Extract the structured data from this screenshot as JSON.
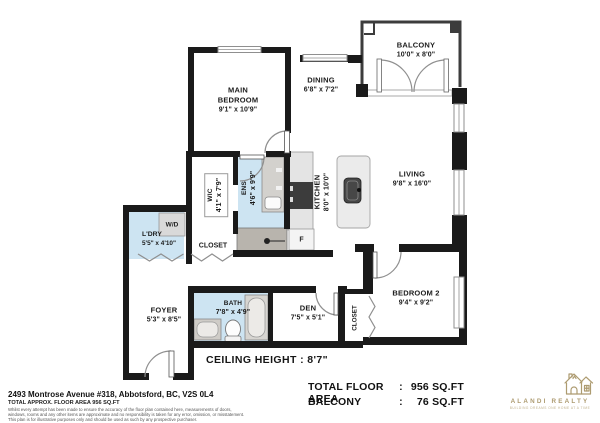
{
  "rooms": {
    "main_bedroom": {
      "name": "MAIN BEDROOM",
      "dims": "9'1\" x 10'9\""
    },
    "dining": {
      "name": "DINING",
      "dims": "6'8\" x 7'2\""
    },
    "balcony": {
      "name": "BALCONY",
      "dims": "10'0\" x 8'0\""
    },
    "living": {
      "name": "LIVING",
      "dims": "9'8\" x 16'0\""
    },
    "kitchen": {
      "name": "KITCHEN",
      "dims": "8'0\" x 10'0\""
    },
    "wic": {
      "name": "WIC",
      "dims": "4'1\" x 7'9\""
    },
    "ens": {
      "name": "ENS",
      "dims": "4'6\" x 9'9\""
    },
    "ldry": {
      "name": "L'DRY",
      "dims": "5'5\" x 4'10\""
    },
    "closet_hall": {
      "name": "CLOSET"
    },
    "foyer": {
      "name": "FOYER",
      "dims": "5'3\" x 8'5\""
    },
    "bath": {
      "name": "BATH",
      "dims": "7'8\" x 4'9\""
    },
    "den": {
      "name": "DEN",
      "dims": "7'5\" x 5'1\""
    },
    "bedroom2": {
      "name": "BEDROOM 2",
      "dims": "9'4\" x 9'2\""
    },
    "closet_bd2": {
      "name": "CLOSET"
    }
  },
  "appliances": {
    "washer_dryer": "W/D",
    "fridge": "F"
  },
  "ceiling_height": "CEILING HEIGHT : 8'7\"",
  "footer": {
    "address": "2493 Montrose Avenue #318, Abbotsford, BC, V2S 0L4",
    "approx_line": "TOTAL APPROX. FLOOR AREA 956 SQ.FT",
    "disclaimer_1": "Whilst every attempt has been made to ensure the accuracy of the floor plan contained here, measurements of doors,",
    "disclaimer_2": "windows, rooms and any other items are approximate and no responsibility is taken for any error, omission, or misstatement.",
    "disclaimer_3": "This plan is for illustrative purposes only and should be used as such by any prospective purchaser.",
    "totals": [
      {
        "label": "TOTAL FLOOR AREA",
        "sep": ":",
        "value": "956 SQ.FT"
      },
      {
        "label": "BALCONY",
        "sep": ":",
        "value": "76 SQ.FT"
      }
    ],
    "brand": {
      "name": "ALANDI REALTY",
      "tagline": "BUILDING DREAMS ONE HOME AT A TIME"
    }
  },
  "colors": {
    "wall": "#1a1a1a",
    "wet_room_blue": "#cde4f2",
    "fixture_gray": "#e4e4e4",
    "counter_gray": "#b8b4ad",
    "appliance_dark": "#3c3c3c",
    "brand_gold": "#ad9b70"
  }
}
